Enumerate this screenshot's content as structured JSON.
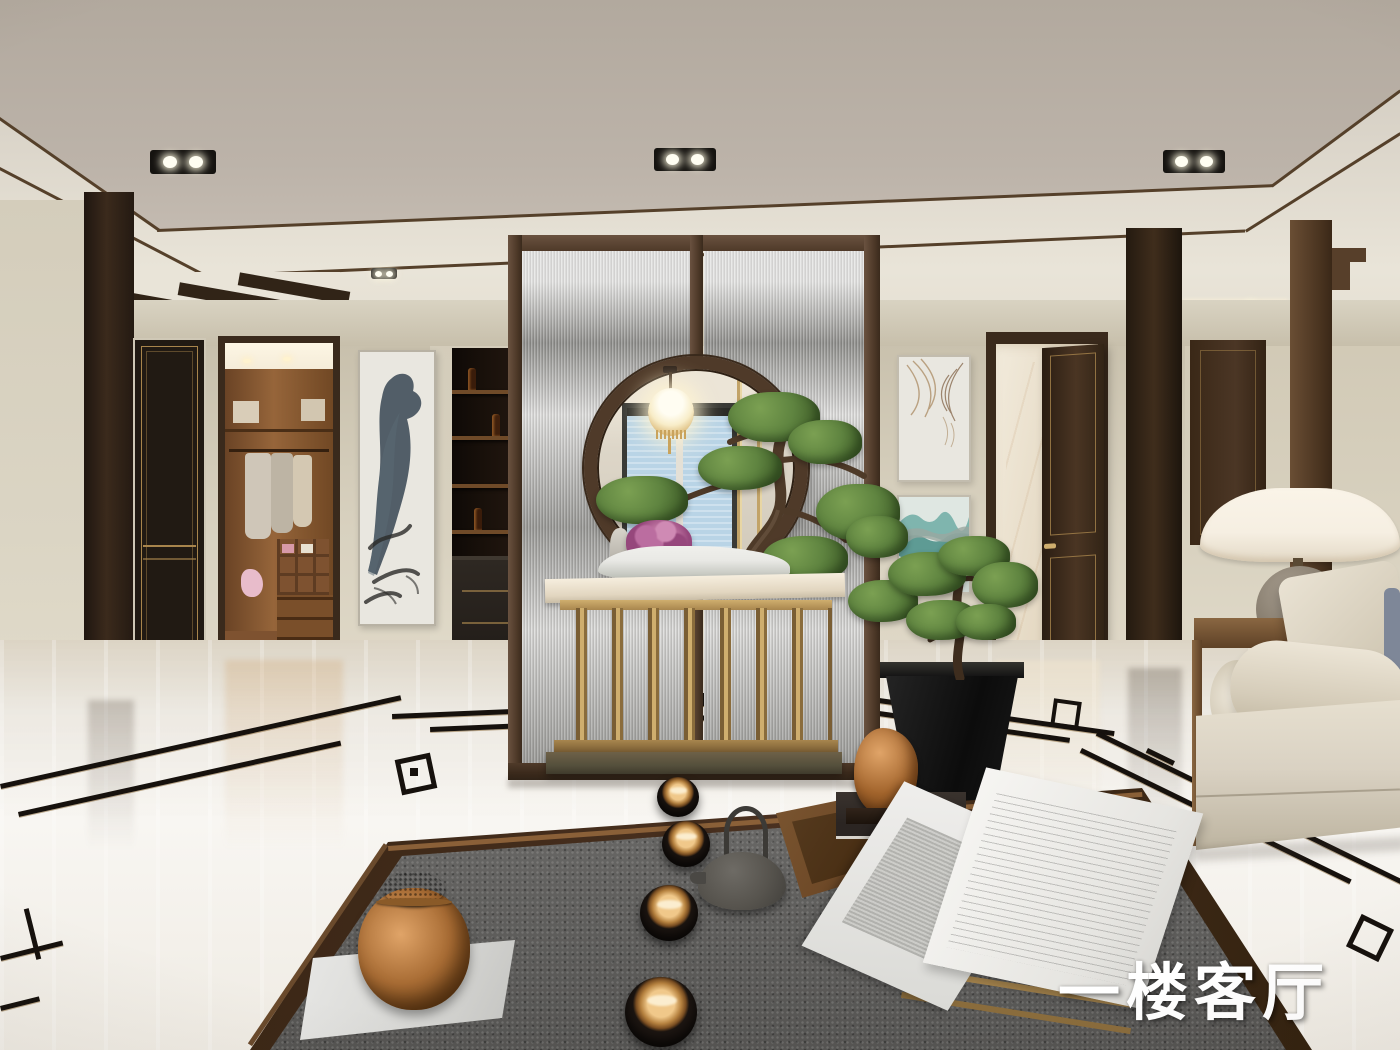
{
  "caption": {
    "text": "一楼客厅"
  },
  "room": {
    "label": "first-floor-living-room",
    "style": "new-chinese-interior-render"
  },
  "objects": [
    "coffered greige ceiling with black twin recessed spotlights",
    "dark walnut ceiling trim and cove lighting",
    "moon-gate reeded-glass partition with round opening",
    "ornate glowing pendant lantern",
    "penjing pine bonsai with pink hydrangea on white scholar stone",
    "brass slat console table with marble top",
    "walk-in closet through open doorway",
    "black lacquer door with gold beading",
    "blue ink-wash scroll artwork",
    "dark bar niche with shelves and bottles",
    "abstract tan line artwork",
    "teal layered-mountain artwork",
    "open walnut door to marble room",
    "stepped decorative wood wall frame",
    "beige fabric sofa with bolster and pillows",
    "dome table lamp with stone sphere base",
    "floor pine bonsai in black tapered planter",
    "bronze foo-dog figurine on books",
    "wood-framed gray granite tea table",
    "four black tea bowls with copper interiors",
    "cast-iron teapot and wooden tray",
    "carved bronze jar on white plinth",
    "open engraving book on brass stand",
    "polished marble floor with black key-fret inlay"
  ],
  "palette": {
    "ceiling": "#b2a99e",
    "ceilingEdge": "#ccc5ba",
    "coveWhite": "#e9e4d8",
    "trimWood": "#55402a",
    "wall": "#d8d1bf",
    "wallShade": "#c7bfab",
    "baseboard": "#ebe8dc",
    "woodDark": "#312417",
    "doorBlack": "#211a13",
    "goldTrim": "#a8854c",
    "closetWood": "#8f5f35",
    "closetDark": "#5e3c22",
    "closetCeil": "#f5ecd9",
    "barDark": "#18100a",
    "shelfWood": "#6f4a28",
    "glassHi": "#cbcbc9",
    "glassLo": "#8e8d8a",
    "ringWood": "#4f3a29",
    "backWall": "#ddd6c8",
    "windowBlue": "#b9d4e6",
    "windowFrame": "#3a3a36",
    "screenGold": "#c2a368",
    "floorMarble": "#f1eee8",
    "floorWarm": "#e2dbcd",
    "inlay": "#16110d",
    "inlayGold": "#8a6a3a",
    "granite": "#61605e",
    "graniteHi": "#6e6d6b",
    "tableWood": "#4a3120",
    "tableWoodHi": "#8a6038",
    "brass": "#a8864e",
    "brassHi": "#cfae6e",
    "plinthBronze": "#6e6148",
    "bronze": "#a86c34",
    "bronzeHi": "#e0a468",
    "bronzeDark": "#5e3812",
    "green": "#5f8440",
    "greenHi": "#7ba052",
    "greenDark": "#44632c",
    "trunkBrown": "#4e3a28",
    "pink": "#bb6da0",
    "pinkDark": "#96477c",
    "rockLight": "#e9e9e5",
    "rockShade": "#b4b7ae",
    "ledge": "#b5b1a9",
    "sofa": "#d9d1c2",
    "sofaShade": "#bdb4a0",
    "pillowBlue": "#7e8798",
    "navy": "#49597c",
    "lampShade": "#f6efe2",
    "lampStone": "#857b6c",
    "lampStoneDark": "#5d564b",
    "marbleWall": "#ede4d3",
    "ironPot": "#57544e",
    "white": "#f7f5f0",
    "captionWhite": "#ffffff",
    "teal1": "#7fb5ae",
    "teal2": "#5e9b94",
    "tealGray": "#9aa8a0",
    "artBg": "#e9e7e0",
    "inkBlue": "#31404d",
    "inkSoft": "#5a6a74",
    "inkDark": "#2b2b28",
    "swirlTan": "#a98a62",
    "swirlBrown": "#7a5a3c",
    "glow": "#fff3da",
    "spotBlack": "#151310"
  }
}
